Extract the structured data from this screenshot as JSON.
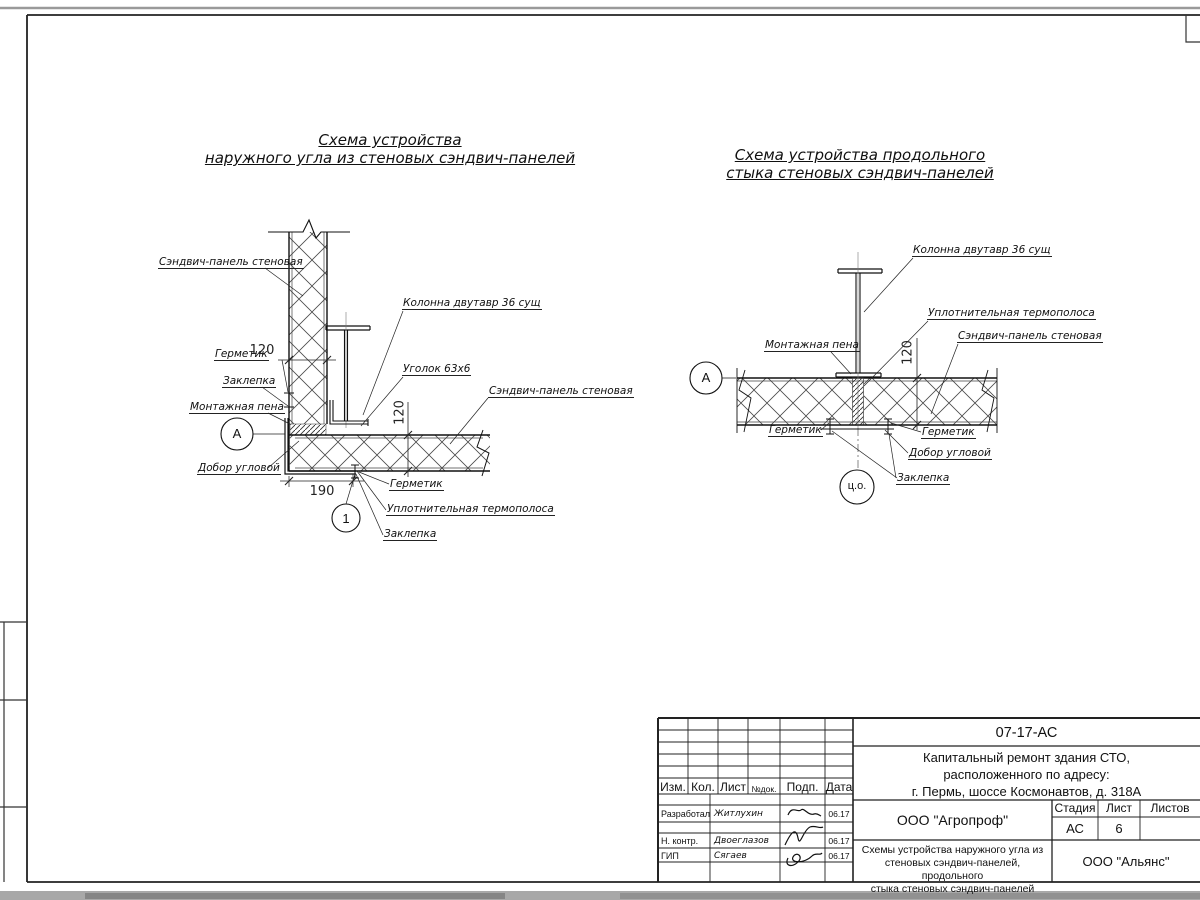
{
  "titles": {
    "d1_line1": "Схема устройства",
    "d1_line2": "наружного угла из стеновых сэндвич-панелей",
    "d2_line1": "Схема устройства продольного",
    "d2_line2": "стыка стеновых сэндвич-панелей"
  },
  "d1": {
    "panel_top": "Сэндвич-панель стеновая",
    "column": "Колонна двутавр 36 сущ",
    "sealant_left": "Герметик",
    "rivet_left": "Заклепка",
    "foam": "Монтажная пена",
    "angle": "Уголок 63х6",
    "panel_right": "Сэндвич-панель стеновая",
    "corner_trim": "Добор угловой",
    "sealant_bottom": "Герметик",
    "thermal_strip": "Уплотнительная термополоса",
    "rivet_bottom": "Заклепка",
    "marker_a": "А",
    "marker_1": "1",
    "dim_panel_thickness": "120",
    "dim_corner": "190",
    "dim_panel_height": "120"
  },
  "d2": {
    "column": "Колонна двутавр 36 сущ",
    "thermal_strip": "Уплотнительная термополоса",
    "panel": "Сэндвич-панель стеновая",
    "foam": "Монтажная пена",
    "sealant_left": "Герметик",
    "sealant_right": "Герметик",
    "corner_trim": "Добор угловой",
    "rivet": "Заклепка",
    "marker_a": "А",
    "marker_co": "ц.о.",
    "dim_panel_thickness": "120"
  },
  "titleblock": {
    "doc_number": "07-17-АС",
    "project_line1": "Капитальный ремонт здания СТО,",
    "project_line2": "расположенного по адресу:",
    "project_line3": "г. Пермь, шоссе Космонавтов, д. 318А",
    "headers": {
      "izm": "Изм.",
      "kol": "Кол.",
      "list": "Лист",
      "ndok": "№док.",
      "podp": "Подп.",
      "data": "Дата"
    },
    "rows": [
      {
        "role": "Разработал",
        "name": "Житлухин",
        "date": "06.17"
      },
      {
        "role": "Н. контр.",
        "name": "Двоеглазов",
        "date": "06.17"
      },
      {
        "role": "ГИП",
        "name": "Сягаев",
        "date": "06.17"
      }
    ],
    "org_designer": "ООО \"Агропроф\"",
    "org_customer": "ООО \"Альянс\"",
    "stage_label": "Стадия",
    "sheet_label": "Лист",
    "sheets_label": "Листов",
    "stage": "АС",
    "sheet": "6",
    "sheets": "",
    "sheet_title_line1": "Схемы устройства наружного угла из",
    "sheet_title_line2": "стеновых сэндвич-панелей, продольного",
    "sheet_title_line3": "стыка стеновых сэндвич-панелей"
  }
}
